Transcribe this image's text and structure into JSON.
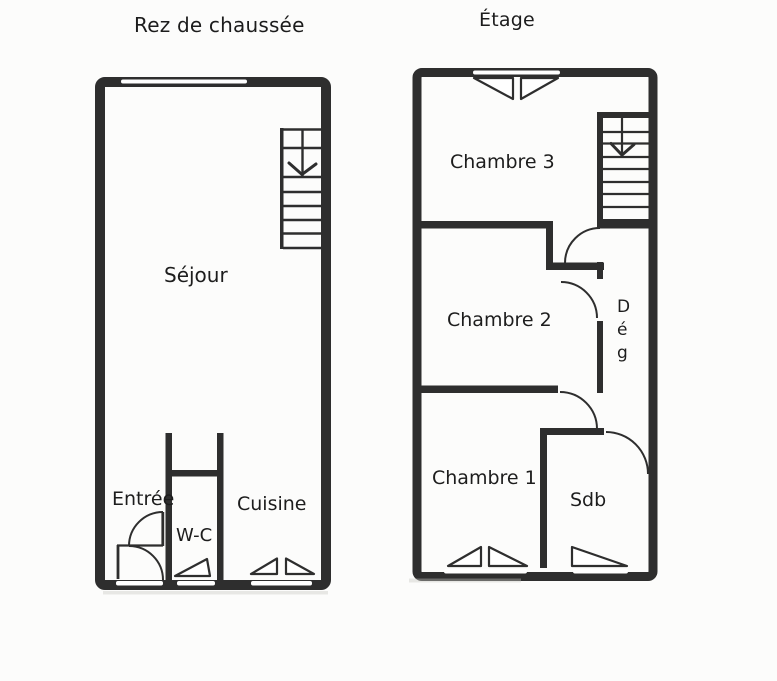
{
  "colors": {
    "ink": "#2e2e2e",
    "paper": "#fcfcfb",
    "window_slit": "#ffffff"
  },
  "floors": [
    {
      "title": "Rez de chaussée",
      "rooms": {
        "sejour": "Séjour",
        "entree": "Entrée",
        "wc": "W-C",
        "cuisine": "Cuisine"
      },
      "icons": [
        "stairs-down-arrow"
      ]
    },
    {
      "title": "Étage",
      "rooms": {
        "chambre3": "Chambre 3",
        "chambre2": "Chambre 2",
        "deg": "Dég",
        "chambre1": "Chambre 1",
        "sdb": "Sdb"
      },
      "icons": [
        "stairs-down-arrow"
      ]
    }
  ]
}
